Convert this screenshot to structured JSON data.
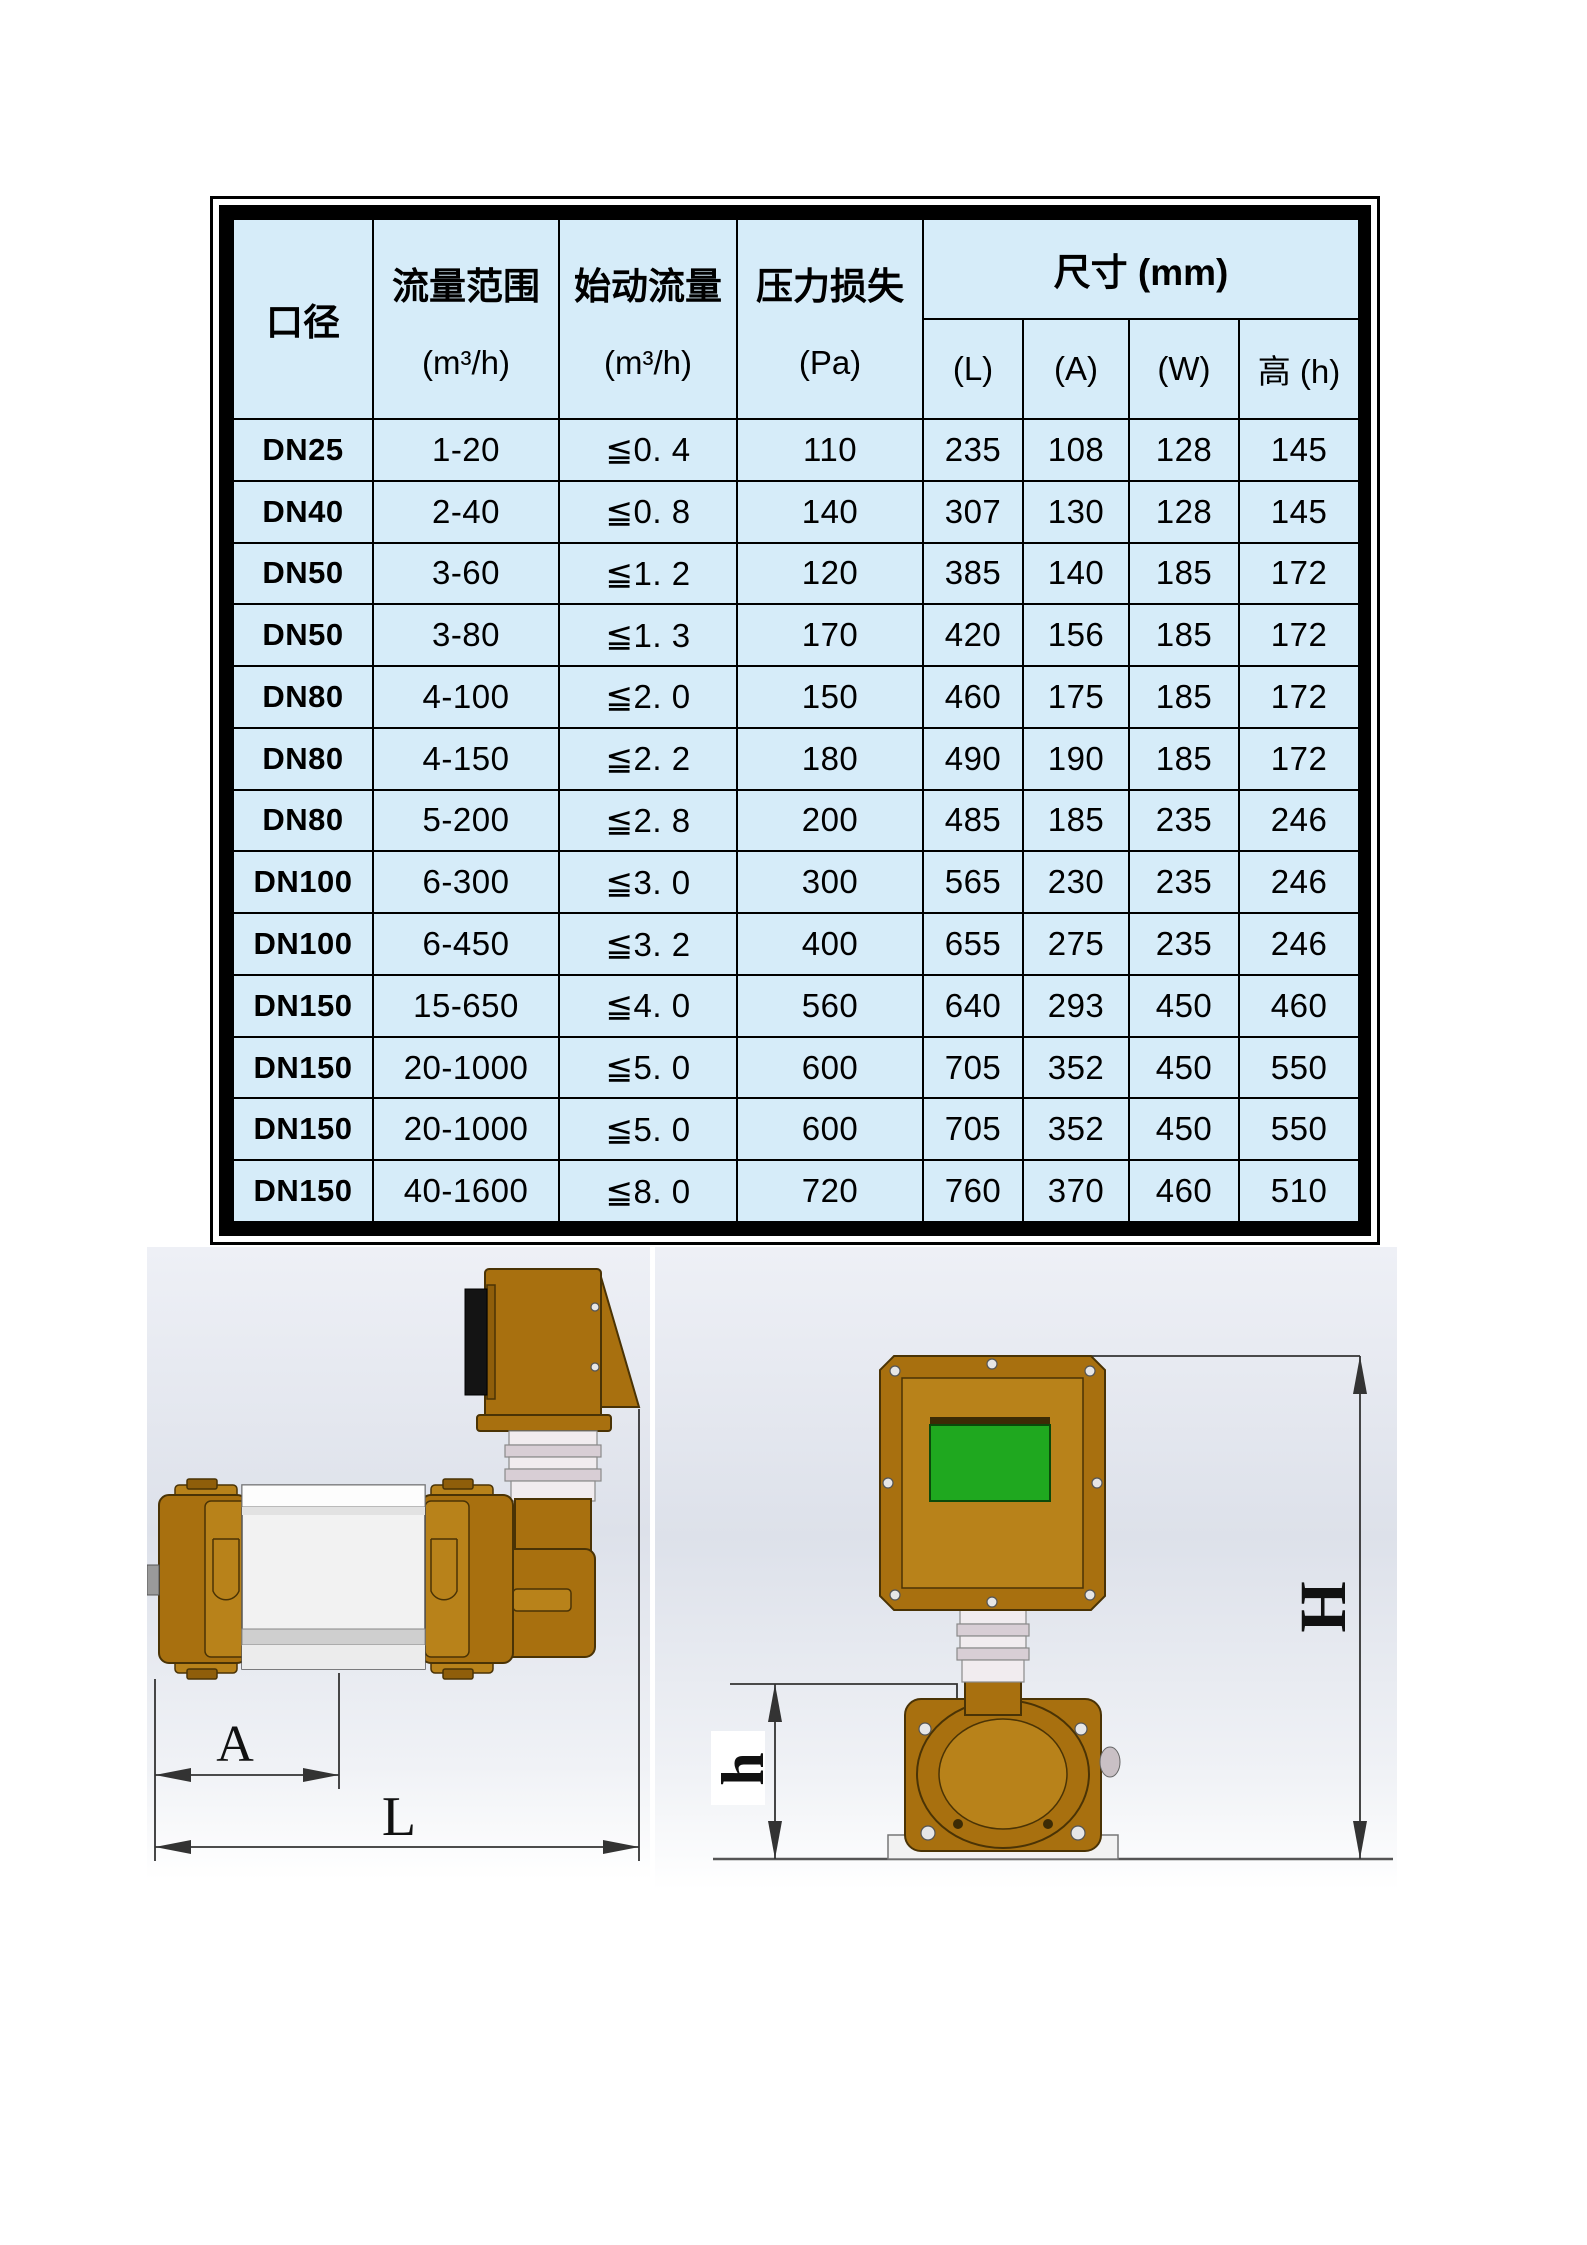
{
  "table": {
    "header": {
      "diameter": "口径",
      "flow_range": "流量范围",
      "flow_range_unit": "(m³/h)",
      "start_flow": "始动流量",
      "start_flow_unit": "(m³/h)",
      "pressure_loss": "压力损失",
      "pressure_loss_unit": "(Pa)",
      "dimensions": "尺寸 (mm)",
      "dim_l": "(L)",
      "dim_a": "(A)",
      "dim_w": "(W)",
      "dim_h": "高 (h)"
    },
    "rows": [
      [
        "DN25",
        "1-20",
        "≦0. 4",
        "110",
        "235",
        "108",
        "128",
        "145"
      ],
      [
        "DN40",
        "2-40",
        "≦0. 8",
        "140",
        "307",
        "130",
        "128",
        "145"
      ],
      [
        "DN50",
        "3-60",
        "≦1. 2",
        "120",
        "385",
        "140",
        "185",
        "172"
      ],
      [
        "DN50",
        "3-80",
        "≦1. 3",
        "170",
        "420",
        "156",
        "185",
        "172"
      ],
      [
        "DN80",
        "4-100",
        "≦2. 0",
        "150",
        "460",
        "175",
        "185",
        "172"
      ],
      [
        "DN80",
        "4-150",
        "≦2. 2",
        "180",
        "490",
        "190",
        "185",
        "172"
      ],
      [
        "DN80",
        "5-200",
        "≦2. 8",
        "200",
        "485",
        "185",
        "235",
        "246"
      ],
      [
        "DN100",
        "6-300",
        "≦3. 0",
        "300",
        "565",
        "230",
        "235",
        "246"
      ],
      [
        "DN100",
        "6-450",
        "≦3. 2",
        "400",
        "655",
        "275",
        "235",
        "246"
      ],
      [
        "DN150",
        "15-650",
        "≦4. 0",
        "560",
        "640",
        "293",
        "450",
        "460"
      ],
      [
        "DN150",
        "20-1000",
        "≦5. 0",
        "600",
        "705",
        "352",
        "450",
        "550"
      ],
      [
        "DN150",
        "20-1000",
        "≦5. 0",
        "600",
        "705",
        "352",
        "450",
        "550"
      ],
      [
        "DN150",
        "40-1600",
        "≦8. 0",
        "720",
        "760",
        "370",
        "460",
        "510"
      ]
    ]
  },
  "drawings": {
    "side_view": {
      "dim_a_label": "A",
      "dim_l_label": "L"
    },
    "front_view": {
      "dim_h_label": "h",
      "dim_total_height_label": "H"
    }
  },
  "colors": {
    "table_bg": "#d6ecf9",
    "device_brown": "#a8700f",
    "device_brown_light": "#b8821a",
    "device_brown_dark": "#4a3305",
    "lcd_green": "#1fa81f",
    "steel_light": "#f1ecef",
    "steel_dark": "#d8ced5",
    "dim_line": "#333333"
  }
}
